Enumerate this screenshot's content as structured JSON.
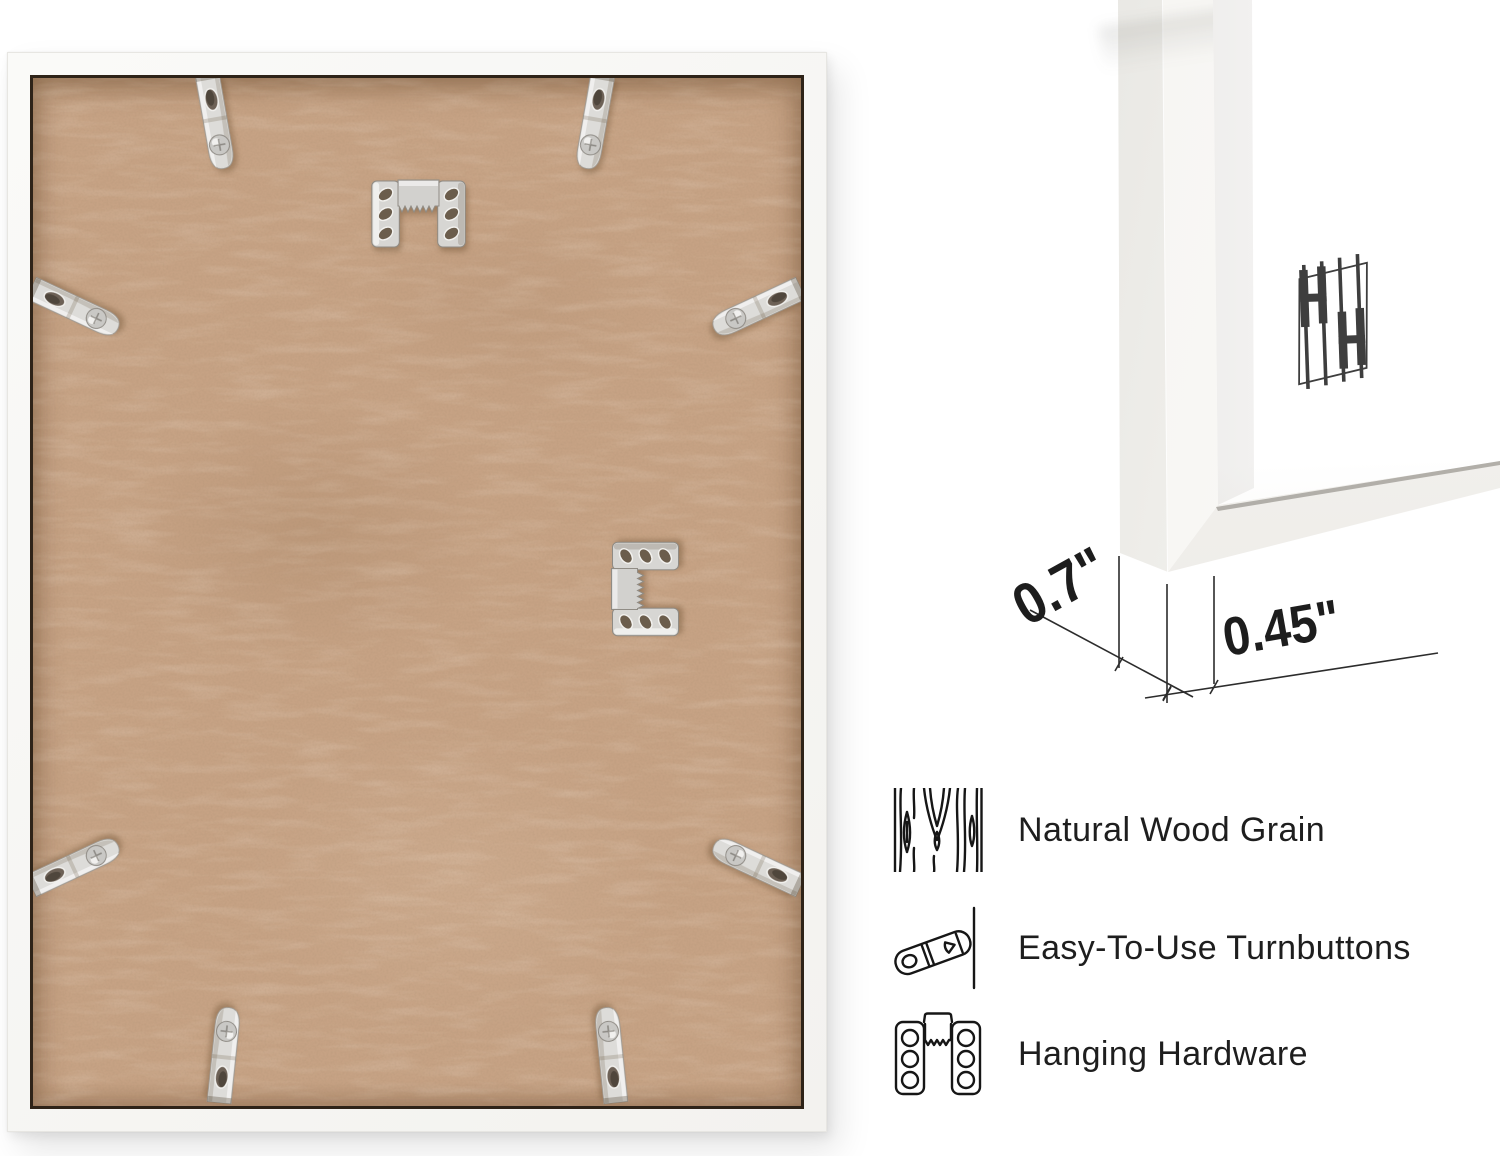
{
  "page": {
    "background": "#ffffff"
  },
  "back_photo": {
    "frame_color": "#f8f7f5",
    "backing_color": "#c6a284",
    "metal_color": "#d9d8d5",
    "hanger_icon": "sawtooth-hanger",
    "turnbutton_icon": "turnbutton-clip"
  },
  "corner_photo": {
    "mat_color": "#ffffff",
    "molding_color": "#f6f5f2",
    "logo": {
      "name": "hh-bars-logo",
      "color": "#3e3e3e"
    }
  },
  "measurements": {
    "depth": "0.7\"",
    "face_width": "0.45\"",
    "line_color": "#2c2c2c"
  },
  "features": {
    "text_color": "#1e1e1e",
    "items": [
      {
        "icon": "wood-grain-icon",
        "label": "Natural Wood Grain"
      },
      {
        "icon": "turnbutton-icon",
        "label": "Easy-To-Use Turnbuttons"
      },
      {
        "icon": "hanging-hardware-icon",
        "label": "Hanging Hardware"
      }
    ]
  }
}
